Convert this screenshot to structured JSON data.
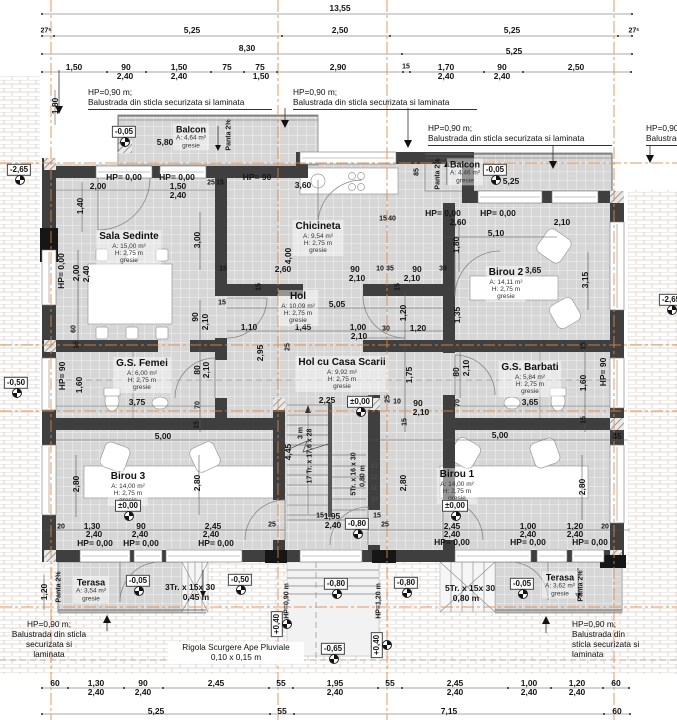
{
  "colors": {
    "axis_line": "#e0873f",
    "wall": "#3f3f3f",
    "tile_floor": "#d6d6d6",
    "level_marker_border": "#444"
  },
  "rooms": [
    {
      "slug": "sala-sedinte",
      "name": "Sala Sedinte",
      "sub": [
        "A: 15,00 m²",
        "H: 2,75 m",
        "gresie"
      ],
      "x": 129,
      "y": 248
    },
    {
      "slug": "chicineta",
      "name": "Chicineta",
      "sub": [
        "A: 9,54 m²",
        "H: 2,75 m",
        "gresie"
      ],
      "x": 318,
      "y": 238
    },
    {
      "slug": "hol",
      "name": "Hol",
      "sub": [
        "A: 10,09 m²",
        "H: 2,75 m",
        "gresie"
      ],
      "x": 298,
      "y": 308
    },
    {
      "slug": "birou-2",
      "name": "Birou 2",
      "sub": [
        "A: 14,11 m²",
        "H: 2,75 m",
        "gresie"
      ],
      "x": 506,
      "y": 284
    },
    {
      "slug": "hol-cu-casa-scarii",
      "name": "Hol cu Casa Scarii",
      "sub": [
        "A: 9,92 m²",
        "H: 2,75 m",
        "gresie"
      ],
      "x": 342,
      "y": 374
    },
    {
      "slug": "gs-femei",
      "name": "G.S. Femei",
      "sub": [
        "A: 6,00 m²",
        "H: 2,75 m",
        "gresie"
      ],
      "x": 142,
      "y": 375
    },
    {
      "slug": "gs-barbati",
      "name": "G.S. Barbati",
      "sub": [
        "A: 5,84 m²",
        "H: 2,75 m",
        "gresie"
      ],
      "x": 530,
      "y": 379
    },
    {
      "slug": "birou-3",
      "name": "Birou 3",
      "sub": [
        "A: 14,00 m²",
        "H: 2,75 m",
        "gresie"
      ],
      "x": 128,
      "y": 488
    },
    {
      "slug": "birou-1",
      "name": "Birou 1",
      "sub": [
        "A: 14,00 m²",
        "H: 2,75 m",
        "gresie"
      ],
      "x": 457,
      "y": 486
    },
    {
      "slug": "balcon-stanga",
      "name": "Balcon",
      "sub": [
        "A: 4,64 m²",
        "gresie"
      ],
      "x": 191,
      "y": 137,
      "sm": true
    },
    {
      "slug": "balcon-dreapta",
      "name": "Balcon",
      "sub": [
        "A: 4,46 m²",
        "gresie"
      ],
      "x": 465,
      "y": 172,
      "sm": true
    },
    {
      "slug": "terasa-stanga",
      "name": "Terasa",
      "sub": [
        "A: 3,54 m²",
        "gresie"
      ],
      "x": 91,
      "y": 590,
      "sm": true
    },
    {
      "slug": "terasa-dreapta",
      "name": "Terasa",
      "sub": [
        "A: 3,62 m²",
        "gresie"
      ],
      "x": 560,
      "y": 585,
      "sm": true
    }
  ],
  "levels": [
    {
      "v": "-0,05",
      "x": 124,
      "y": 132
    },
    {
      "v": "-2,65",
      "x": 19,
      "y": 170
    },
    {
      "v": "-0,05",
      "x": 495,
      "y": 170
    },
    {
      "v": "-0,50",
      "x": 16,
      "y": 383
    },
    {
      "v": "±0,00",
      "x": 360,
      "y": 402
    },
    {
      "v": "±0,00",
      "x": 128,
      "y": 506
    },
    {
      "v": "±0,00",
      "x": 455,
      "y": 506
    },
    {
      "v": "-0,80",
      "x": 357,
      "y": 524
    },
    {
      "v": "-0,05",
      "x": 138,
      "y": 581
    },
    {
      "v": "-0,50",
      "x": 240,
      "y": 580
    },
    {
      "v": "-0,80",
      "x": 336,
      "y": 584
    },
    {
      "v": "-0,80",
      "x": 406,
      "y": 583
    },
    {
      "v": "-0,05",
      "x": 522,
      "y": 584
    },
    {
      "v": "+0,40",
      "x": 277,
      "y": 624,
      "vert": true
    },
    {
      "v": "+0,40",
      "x": 377,
      "y": 645,
      "vert": true
    },
    {
      "v": "-0,65",
      "x": 333,
      "y": 649
    },
    {
      "v": "-2,65",
      "x": 671,
      "y": 300
    }
  ],
  "notes": [
    {
      "lines": [
        "HP=0,90 m;",
        "Balustrada din sticla securizata si laminata"
      ],
      "x": 88,
      "y": 88,
      "u": true,
      "w": 184
    },
    {
      "lines": [
        "HP=0,90 m;",
        "Balustrada din sticla securizata si laminata"
      ],
      "x": 293,
      "y": 88,
      "u": true,
      "w": 184
    },
    {
      "lines": [
        "HP=0,90 m;",
        "Balustrada din sticla securizata si laminata"
      ],
      "x": 428,
      "y": 124,
      "u": true,
      "w": 184
    },
    {
      "lines": [
        "HP=0,90 m;",
        "Balustrada din sticla securizata si laminata"
      ],
      "x": 646,
      "y": 124,
      "u": true,
      "w": 184
    },
    {
      "lines": [
        "HP=0,90 m;",
        "Balustrada din sticla",
        "securizata si",
        "laminata"
      ],
      "x": 8,
      "y": 620,
      "w": 82,
      "center": true
    },
    {
      "lines": [
        "Rigola Scurgere Ape Pluviale",
        "0,10 x 0,15 m"
      ],
      "x": 168,
      "y": 642,
      "w": 132,
      "center": true,
      "bg": true
    },
    {
      "lines": [
        "HP=0,90 m;",
        "Balustrada din",
        "sticla securizata si",
        "laminata"
      ],
      "x": 572,
      "y": 620
    }
  ],
  "dims": [
    {
      "t": "13,55",
      "x": 340,
      "y": 8
    },
    {
      "t": "27⁵",
      "x": 46,
      "y": 31,
      "c": "s"
    },
    {
      "t": "5,25",
      "x": 192,
      "y": 30
    },
    {
      "t": "2,50",
      "x": 340,
      "y": 30
    },
    {
      "t": "5,25",
      "x": 512,
      "y": 30
    },
    {
      "t": "27⁵",
      "x": 634,
      "y": 31,
      "c": "s"
    },
    {
      "t": "8,30",
      "x": 247,
      "y": 48
    },
    {
      "t": "5,25",
      "x": 514,
      "y": 51
    },
    {
      "t": "1,50",
      "x": 74,
      "y": 67
    },
    {
      "t": "90",
      "x": 126,
      "y": 67
    },
    {
      "t": "2,40",
      "x": 125,
      "y": 76
    },
    {
      "t": "1,50",
      "x": 179,
      "y": 67
    },
    {
      "t": "2,40",
      "x": 179,
      "y": 76
    },
    {
      "t": "75",
      "x": 227,
      "y": 67
    },
    {
      "t": "75",
      "x": 260,
      "y": 67
    },
    {
      "t": "1,50",
      "x": 261,
      "y": 76
    },
    {
      "t": "2,90",
      "x": 338,
      "y": 67
    },
    {
      "t": "15",
      "x": 406,
      "y": 67,
      "c": "s"
    },
    {
      "t": "1,70",
      "x": 446,
      "y": 67
    },
    {
      "t": "2,40",
      "x": 446,
      "y": 76
    },
    {
      "t": "90",
      "x": 502,
      "y": 67
    },
    {
      "t": "2,40",
      "x": 502,
      "y": 76
    },
    {
      "t": "2,50",
      "x": 576,
      "y": 67
    },
    {
      "t": "1,80",
      "x": 55,
      "y": 106,
      "c": "v"
    },
    {
      "t": "5,80",
      "x": 165,
      "y": 142
    },
    {
      "t": "Panta 2%",
      "x": 229,
      "y": 135,
      "c": "v s"
    },
    {
      "t": "85",
      "x": 417,
      "y": 172,
      "c": "v s"
    },
    {
      "t": "Panta 2%",
      "x": 438,
      "y": 174,
      "c": "v s"
    },
    {
      "t": "5,25",
      "x": 511,
      "y": 181
    },
    {
      "t": "HP= 0,00",
      "x": 124,
      "y": 177
    },
    {
      "t": "HP= 0,00",
      "x": 177,
      "y": 177
    },
    {
      "t": "2,00",
      "x": 98,
      "y": 186
    },
    {
      "t": "1,50",
      "x": 178,
      "y": 186
    },
    {
      "t": "2,40",
      "x": 178,
      "y": 195
    },
    {
      "t": "25",
      "x": 211,
      "y": 183,
      "c": "s"
    },
    {
      "t": "15",
      "x": 220,
      "y": 183,
      "c": "s"
    },
    {
      "t": "HP= 90",
      "x": 257,
      "y": 177
    },
    {
      "t": "3,60",
      "x": 303,
      "y": 185
    },
    {
      "t": "15",
      "x": 383,
      "y": 219,
      "c": "s"
    },
    {
      "t": "40",
      "x": 392,
      "y": 219,
      "c": "s"
    },
    {
      "t": "HP= 0,00",
      "x": 443,
      "y": 213
    },
    {
      "t": "HP= 0,00",
      "x": 498,
      "y": 213
    },
    {
      "t": "2,60",
      "x": 458,
      "y": 222
    },
    {
      "t": "2,10",
      "x": 562,
      "y": 222
    },
    {
      "t": "5,10",
      "x": 496,
      "y": 233
    },
    {
      "t": "1,40",
      "x": 80,
      "y": 206,
      "c": "v"
    },
    {
      "t": "3,00",
      "x": 197,
      "y": 240,
      "c": "v"
    },
    {
      "t": "1,80",
      "x": 456,
      "y": 245,
      "c": "v"
    },
    {
      "t": "35",
      "x": 443,
      "y": 269,
      "c": "s"
    },
    {
      "t": "3,65",
      "x": 533,
      "y": 270
    },
    {
      "t": "3,15",
      "x": 585,
      "y": 280,
      "c": "v"
    },
    {
      "t": "1,35",
      "x": 457,
      "y": 315,
      "c": "v"
    },
    {
      "t": "HP= 0,00",
      "x": 61,
      "y": 271,
      "c": "v"
    },
    {
      "t": "2,00",
      "x": 76,
      "y": 273,
      "c": "v"
    },
    {
      "t": "2,40",
      "x": 86,
      "y": 274,
      "c": "v"
    },
    {
      "t": "60",
      "x": 74,
      "y": 329,
      "c": "v s"
    },
    {
      "t": "15",
      "x": 77,
      "y": 345,
      "c": "v s"
    },
    {
      "t": "4,00",
      "x": 288,
      "y": 256,
      "c": "v"
    },
    {
      "t": "2,60",
      "x": 283,
      "y": 269
    },
    {
      "t": "15",
      "x": 223,
      "y": 269,
      "c": "s"
    },
    {
      "t": "15",
      "x": 259,
      "y": 287,
      "c": "v s"
    },
    {
      "t": "90",
      "x": 355,
      "y": 269
    },
    {
      "t": "2,10",
      "x": 357,
      "y": 278
    },
    {
      "t": "10",
      "x": 380,
      "y": 269,
      "c": "s"
    },
    {
      "t": "35",
      "x": 390,
      "y": 269,
      "c": "s"
    },
    {
      "t": "90",
      "x": 417,
      "y": 269
    },
    {
      "t": "2,10",
      "x": 412,
      "y": 278
    },
    {
      "t": "15",
      "x": 398,
      "y": 287,
      "c": "v s"
    },
    {
      "t": "5,05",
      "x": 337,
      "y": 304
    },
    {
      "t": "15",
      "x": 222,
      "y": 303,
      "c": "s"
    },
    {
      "t": "90",
      "x": 195,
      "y": 317,
      "c": "v"
    },
    {
      "t": "2,10",
      "x": 205,
      "y": 322,
      "c": "v"
    },
    {
      "t": "1,10",
      "x": 249,
      "y": 327
    },
    {
      "t": "1,45",
      "x": 303,
      "y": 327
    },
    {
      "t": "1,00",
      "x": 358,
      "y": 327
    },
    {
      "t": "2,10",
      "x": 359,
      "y": 336
    },
    {
      "t": "30",
      "x": 386,
      "y": 329,
      "c": "s"
    },
    {
      "t": "1,20",
      "x": 418,
      "y": 328
    },
    {
      "t": "1,20",
      "x": 403,
      "y": 313,
      "c": "v"
    },
    {
      "t": "1,75",
      "x": 409,
      "y": 375,
      "c": "v"
    },
    {
      "t": "2,95",
      "x": 260,
      "y": 353,
      "c": "v"
    },
    {
      "t": "25",
      "x": 288,
      "y": 347,
      "c": "v s"
    },
    {
      "t": "80",
      "x": 197,
      "y": 370,
      "c": "v"
    },
    {
      "t": "2,10",
      "x": 206,
      "y": 370,
      "c": "v"
    },
    {
      "t": "HP= 90",
      "x": 62,
      "y": 376,
      "c": "v"
    },
    {
      "t": "1,60",
      "x": 79,
      "y": 385,
      "c": "v"
    },
    {
      "t": "3,75",
      "x": 137,
      "y": 402
    },
    {
      "t": "70",
      "x": 198,
      "y": 405,
      "c": "v s"
    },
    {
      "t": "15",
      "x": 197,
      "y": 425,
      "c": "v s"
    },
    {
      "t": "80",
      "x": 456,
      "y": 372,
      "c": "v"
    },
    {
      "t": "2,10",
      "x": 466,
      "y": 368,
      "c": "v"
    },
    {
      "t": "70",
      "x": 458,
      "y": 403,
      "c": "v s"
    },
    {
      "t": "3,65",
      "x": 530,
      "y": 402
    },
    {
      "t": "1,60",
      "x": 583,
      "y": 383,
      "c": "v"
    },
    {
      "t": "HP= 90",
      "x": 603,
      "y": 372,
      "c": "v"
    },
    {
      "t": "15",
      "x": 584,
      "y": 346,
      "c": "v s"
    },
    {
      "t": "15",
      "x": 584,
      "y": 420,
      "c": "v s"
    },
    {
      "t": "5,00",
      "x": 163,
      "y": 436
    },
    {
      "t": "5,00",
      "x": 500,
      "y": 435
    },
    {
      "t": "45",
      "x": 617,
      "y": 436
    },
    {
      "t": "2,25",
      "x": 327,
      "y": 400
    },
    {
      "t": "25",
      "x": 388,
      "y": 399,
      "c": "v s"
    },
    {
      "t": "10",
      "x": 397,
      "y": 402,
      "c": "s"
    },
    {
      "t": "90",
      "x": 418,
      "y": 403
    },
    {
      "t": "2,10",
      "x": 421,
      "y": 412
    },
    {
      "t": "15",
      "x": 405,
      "y": 422,
      "c": "v s"
    },
    {
      "t": "17 Tr. x 17,6 x 28",
      "x": 310,
      "y": 456,
      "c": "v s"
    },
    {
      "t": "3 m",
      "x": 301,
      "y": 433,
      "c": "v s"
    },
    {
      "t": "4,45",
      "x": 288,
      "y": 452,
      "c": "v"
    },
    {
      "t": "5Tr. x 16 x 30",
      "x": 354,
      "y": 474,
      "c": "v s"
    },
    {
      "t": "0,80 m",
      "x": 363,
      "y": 476,
      "c": "v s"
    },
    {
      "t": "13",
      "x": 374,
      "y": 467,
      "c": "x"
    },
    {
      "t": "12",
      "x": 374,
      "y": 478,
      "c": "x"
    },
    {
      "t": "11",
      "x": 374,
      "y": 489,
      "c": "x"
    },
    {
      "t": "10",
      "x": 374,
      "y": 500,
      "c": "x"
    },
    {
      "t": "2,80",
      "x": 403,
      "y": 483,
      "c": "v"
    },
    {
      "t": "1,95",
      "x": 332,
      "y": 516
    },
    {
      "t": "2,40",
      "x": 333,
      "y": 525
    },
    {
      "t": "15",
      "x": 320,
      "y": 516,
      "c": "s"
    },
    {
      "t": "15",
      "x": 377,
      "y": 516,
      "c": "s"
    },
    {
      "t": "25",
      "x": 272,
      "y": 525,
      "c": "s"
    },
    {
      "t": "25",
      "x": 385,
      "y": 525,
      "c": "s"
    },
    {
      "t": "2,80",
      "x": 76,
      "y": 484,
      "c": "v"
    },
    {
      "t": "2,80",
      "x": 197,
      "y": 483,
      "c": "v"
    },
    {
      "t": "20",
      "x": 61,
      "y": 527,
      "c": "s"
    },
    {
      "t": "1,30",
      "x": 92,
      "y": 526
    },
    {
      "t": "2,40",
      "x": 94,
      "y": 534
    },
    {
      "t": "90",
      "x": 141,
      "y": 526
    },
    {
      "t": "2,40",
      "x": 140,
      "y": 534
    },
    {
      "t": "2,45",
      "x": 213,
      "y": 526
    },
    {
      "t": "2,40",
      "x": 211,
      "y": 534
    },
    {
      "t": "HP= 0,00",
      "x": 95,
      "y": 543
    },
    {
      "t": "HP= 0,00",
      "x": 141,
      "y": 543
    },
    {
      "t": "HP= 0,00",
      "x": 216,
      "y": 543
    },
    {
      "t": "2,80",
      "x": 582,
      "y": 487,
      "c": "v"
    },
    {
      "t": "2,45",
      "x": 452,
      "y": 526
    },
    {
      "t": "2,40",
      "x": 452,
      "y": 534
    },
    {
      "t": "1,00",
      "x": 528,
      "y": 526
    },
    {
      "t": "2,40",
      "x": 528,
      "y": 534
    },
    {
      "t": "1,20",
      "x": 575,
      "y": 526
    },
    {
      "t": "2,40",
      "x": 575,
      "y": 534
    },
    {
      "t": "20",
      "x": 605,
      "y": 527,
      "c": "s"
    },
    {
      "t": "HP= 0,00",
      "x": 452,
      "y": 542
    },
    {
      "t": "HP= 0,00",
      "x": 528,
      "y": 542
    },
    {
      "t": "HP= 0,00",
      "x": 590,
      "y": 542
    },
    {
      "t": "1,20",
      "x": 44,
      "y": 592,
      "c": "v"
    },
    {
      "t": "Panta 2%",
      "x": 59,
      "y": 587,
      "c": "v s"
    },
    {
      "t": "3Tr. x 15x 30",
      "x": 190,
      "y": 587
    },
    {
      "t": "0,45 m",
      "x": 196,
      "y": 597
    },
    {
      "t": "5Tr. x 15x 30",
      "x": 470,
      "y": 588
    },
    {
      "t": "0,80 m",
      "x": 466,
      "y": 598
    },
    {
      "t": "Panta 2%",
      "x": 581,
      "y": 586,
      "c": "v s"
    },
    {
      "t": "HP=0,90 m",
      "x": 287,
      "y": 601,
      "c": "v s"
    },
    {
      "t": "HP=1,20 m",
      "x": 379,
      "y": 601,
      "c": "v s"
    },
    {
      "t": "60",
      "x": 55,
      "y": 683
    },
    {
      "t": "1,30",
      "x": 96,
      "y": 683
    },
    {
      "t": "2,40",
      "x": 96,
      "y": 692
    },
    {
      "t": "90",
      "x": 143,
      "y": 683
    },
    {
      "t": "2,40",
      "x": 143,
      "y": 692
    },
    {
      "t": "2,45",
      "x": 216,
      "y": 683
    },
    {
      "t": "55",
      "x": 281,
      "y": 683
    },
    {
      "t": "1,95",
      "x": 335,
      "y": 683
    },
    {
      "t": "2,40",
      "x": 335,
      "y": 692
    },
    {
      "t": "55",
      "x": 390,
      "y": 683
    },
    {
      "t": "2,45",
      "x": 455,
      "y": 683
    },
    {
      "t": "2,40",
      "x": 455,
      "y": 692
    },
    {
      "t": "1,00",
      "x": 529,
      "y": 683
    },
    {
      "t": "2,40",
      "x": 529,
      "y": 692
    },
    {
      "t": "1,20",
      "x": 577,
      "y": 683
    },
    {
      "t": "2,40",
      "x": 577,
      "y": 692
    },
    {
      "t": "60",
      "x": 616,
      "y": 683
    },
    {
      "t": "5,25",
      "x": 156,
      "y": 711
    },
    {
      "t": "55",
      "x": 282,
      "y": 711
    },
    {
      "t": "7,15",
      "x": 449,
      "y": 711
    },
    {
      "t": "60",
      "x": 617,
      "y": 711
    }
  ]
}
